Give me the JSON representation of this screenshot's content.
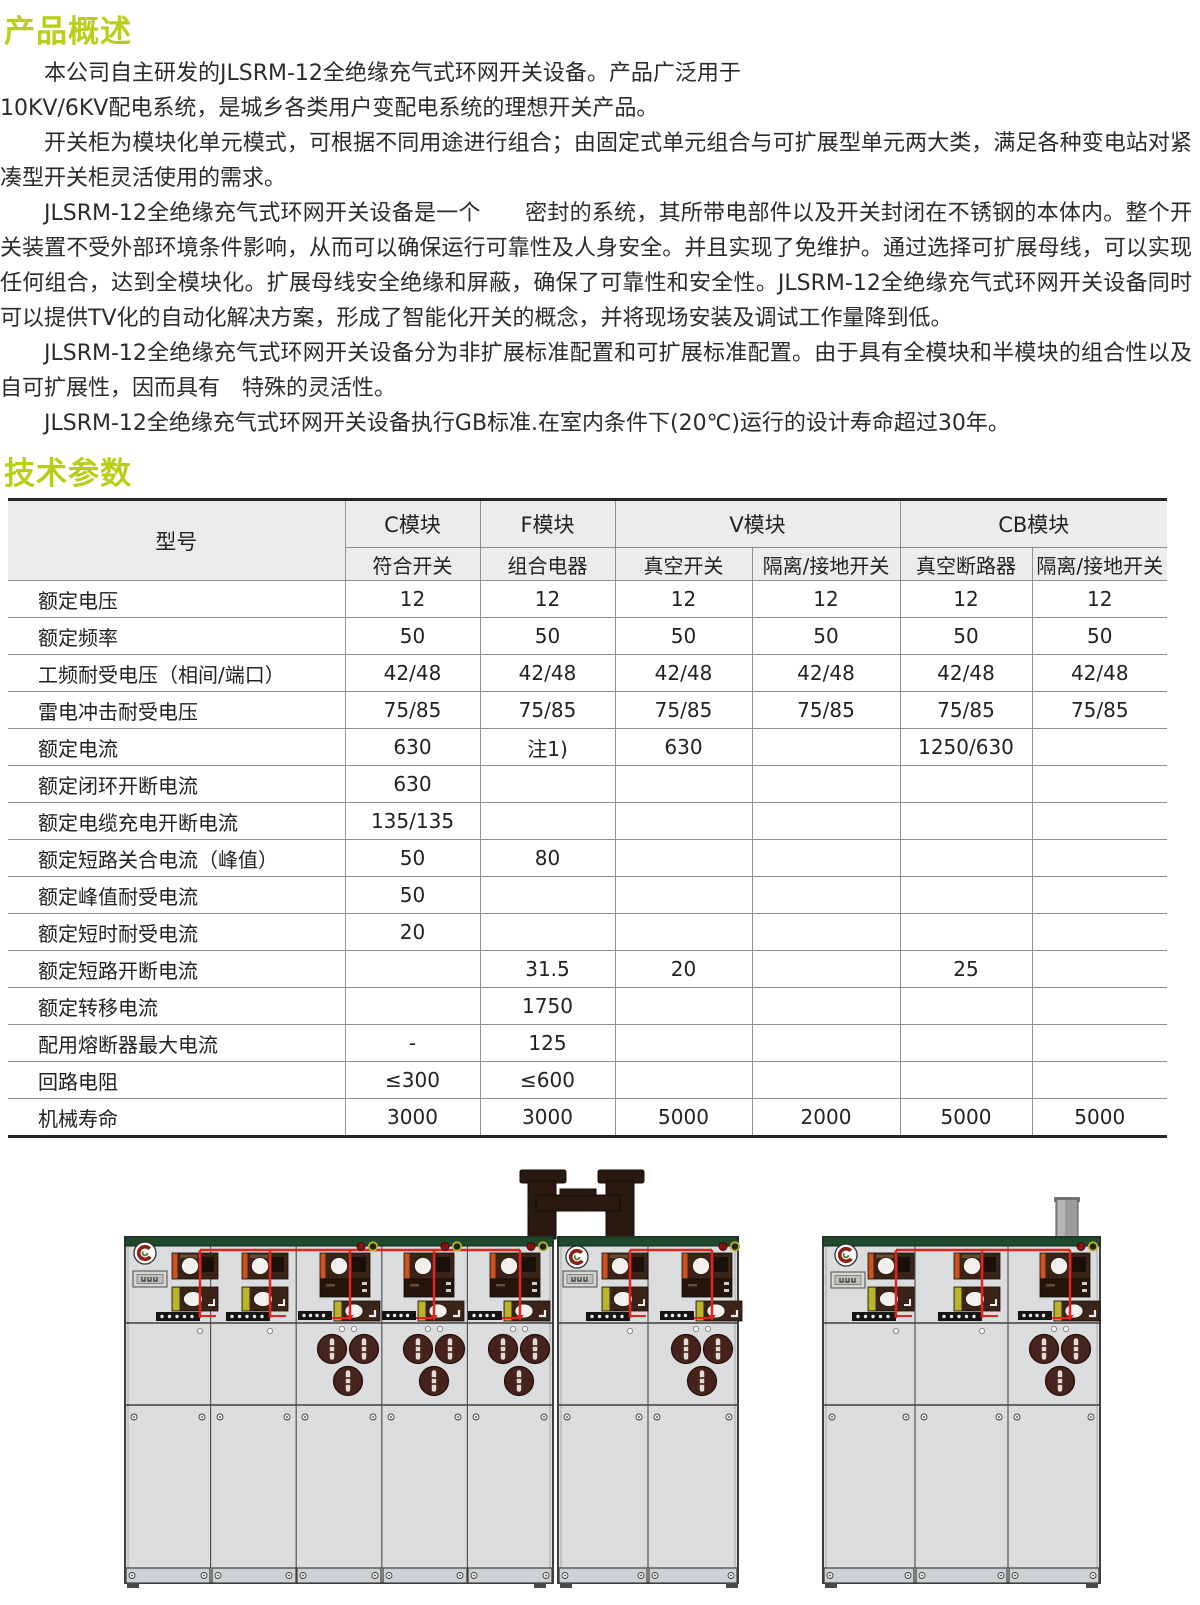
{
  "page": {
    "overview_heading": "产品概述",
    "tech_heading": "技术参数"
  },
  "overview": {
    "lines": [
      {
        "text": "本公司自主研发的JLSRM-12全绝缘充气式环网开关设备。产品广泛用于"
      },
      {
        "text": "10KV/6KV配电系统，是城乡各类用户变配电系统的理想开关产品。"
      },
      {
        "text": "开关柜为模块化单元模式，可根据不同用途进行组合；由固定式单元组合与可扩展型单元两大类，满足各种变电站对紧凑型开关柜灵活使用的需求。"
      },
      {
        "text": "JLSRM-12全绝缘充气式环网开关设备是一个　　密封的系统，其所带电部件以及开关封闭在不锈钢的本体内。整个开关装置不受外部环境条件影响，从而可以确保运行可靠性及人身安全。并且实现了免维护。通过选择可扩展母线，可以实现任何组合，达到全模块化。扩展母线安全绝缘和屏蔽，确保了可靠性和安全性。JLSRM-12全绝缘充气式环网开关设备同时可以提供TV化的自动化解决方案，形成了智能化开关的概念，并将现场安装及调试工作量降到低。"
      },
      {
        "text": "JLSRM-12全绝缘充气式环网开关设备分为非扩展标准配置和可扩展标准配置。由于具有全模块和半模块的组合性以及自可扩展性，因而具有　特殊的灵活性。"
      },
      {
        "text": "JLSRM-12全绝缘充气式环网开关设备执行GB标准.在室内条件下(20℃)运行的设计寿命超过30年。"
      }
    ]
  },
  "table": {
    "col_model_label": "型号",
    "groups": [
      {
        "label": "C模块",
        "sub": [
          "符合开关"
        ]
      },
      {
        "label": "F模块",
        "sub": [
          "组合电器"
        ]
      },
      {
        "label": "V模块",
        "sub": [
          "真空开关",
          "隔离/接地开关"
        ]
      },
      {
        "label": "CB模块",
        "sub": [
          "真空断路器",
          "隔离/接地开关"
        ]
      }
    ],
    "rows": [
      {
        "label": "额定电压",
        "values": [
          "12",
          "12",
          "12",
          "12",
          "12",
          "12"
        ]
      },
      {
        "label": "额定频率",
        "values": [
          "50",
          "50",
          "50",
          "50",
          "50",
          "50"
        ]
      },
      {
        "label": "工频耐受电压（相间/端口）",
        "values": [
          "42/48",
          "42/48",
          "42/48",
          "42/48",
          "42/48",
          "42/48"
        ]
      },
      {
        "label": "雷电冲击耐受电压",
        "values": [
          "75/85",
          "75/85",
          "75/85",
          "75/85",
          "75/85",
          "75/85"
        ]
      },
      {
        "label": "额定电流",
        "values": [
          "630",
          "注1)",
          "630",
          "",
          "1250/630",
          ""
        ]
      },
      {
        "label": "额定闭环开断电流",
        "values": [
          "630",
          "",
          "",
          "",
          "",
          ""
        ]
      },
      {
        "label": "额定电缆充电开断电流",
        "values": [
          "135/135",
          "",
          "",
          "",
          "",
          ""
        ]
      },
      {
        "label": "额定短路关合电流（峰值）",
        "values": [
          "50",
          "80",
          "",
          "",
          "",
          ""
        ]
      },
      {
        "label": "额定峰值耐受电流",
        "values": [
          "50",
          "",
          "",
          "",
          "",
          ""
        ]
      },
      {
        "label": "额定短时耐受电流",
        "values": [
          "20",
          "",
          "",
          "",
          "",
          ""
        ]
      },
      {
        "label": "额定短路开断电流",
        "values": [
          "",
          "31.5",
          "20",
          "",
          "25",
          ""
        ]
      },
      {
        "label": "额定转移电流",
        "values": [
          "",
          "1750",
          "",
          "",
          "",
          ""
        ]
      },
      {
        "label": "配用熔断器最大电流",
        "values": [
          "-",
          "125",
          "",
          "",
          "",
          ""
        ]
      },
      {
        "label": "回路电阻",
        "values": [
          "≤300",
          "≤600",
          "",
          "",
          "",
          ""
        ]
      },
      {
        "label": "机械寿命",
        "values": [
          "3000",
          "3000",
          "5000",
          "2000",
          "5000",
          "5000"
        ]
      }
    ]
  },
  "figure": {
    "cabinets": [
      {
        "id": "left-unit",
        "panels": 5
      },
      {
        "id": "middle-unit",
        "panels": 2
      },
      {
        "id": "right-unit",
        "panels": 3
      }
    ],
    "colors": {
      "cabinet_body": "#dadcde",
      "top_strip_green": "#1e4a2b",
      "wire_red": "#e3231c",
      "module_brown": "#3a2317",
      "module_orange": "#cf521d",
      "module_yellow_green": "#b9b428",
      "fuse_brown": "#45221b",
      "busbar_dark": "#2a190e",
      "duct_gray": "#9c9c9a"
    }
  },
  "colors": {
    "heading_green": "#b7cf17",
    "body_text": "#2b2b2b",
    "table_header_bg": "#ececec",
    "table_border": "#8f8f8f"
  }
}
